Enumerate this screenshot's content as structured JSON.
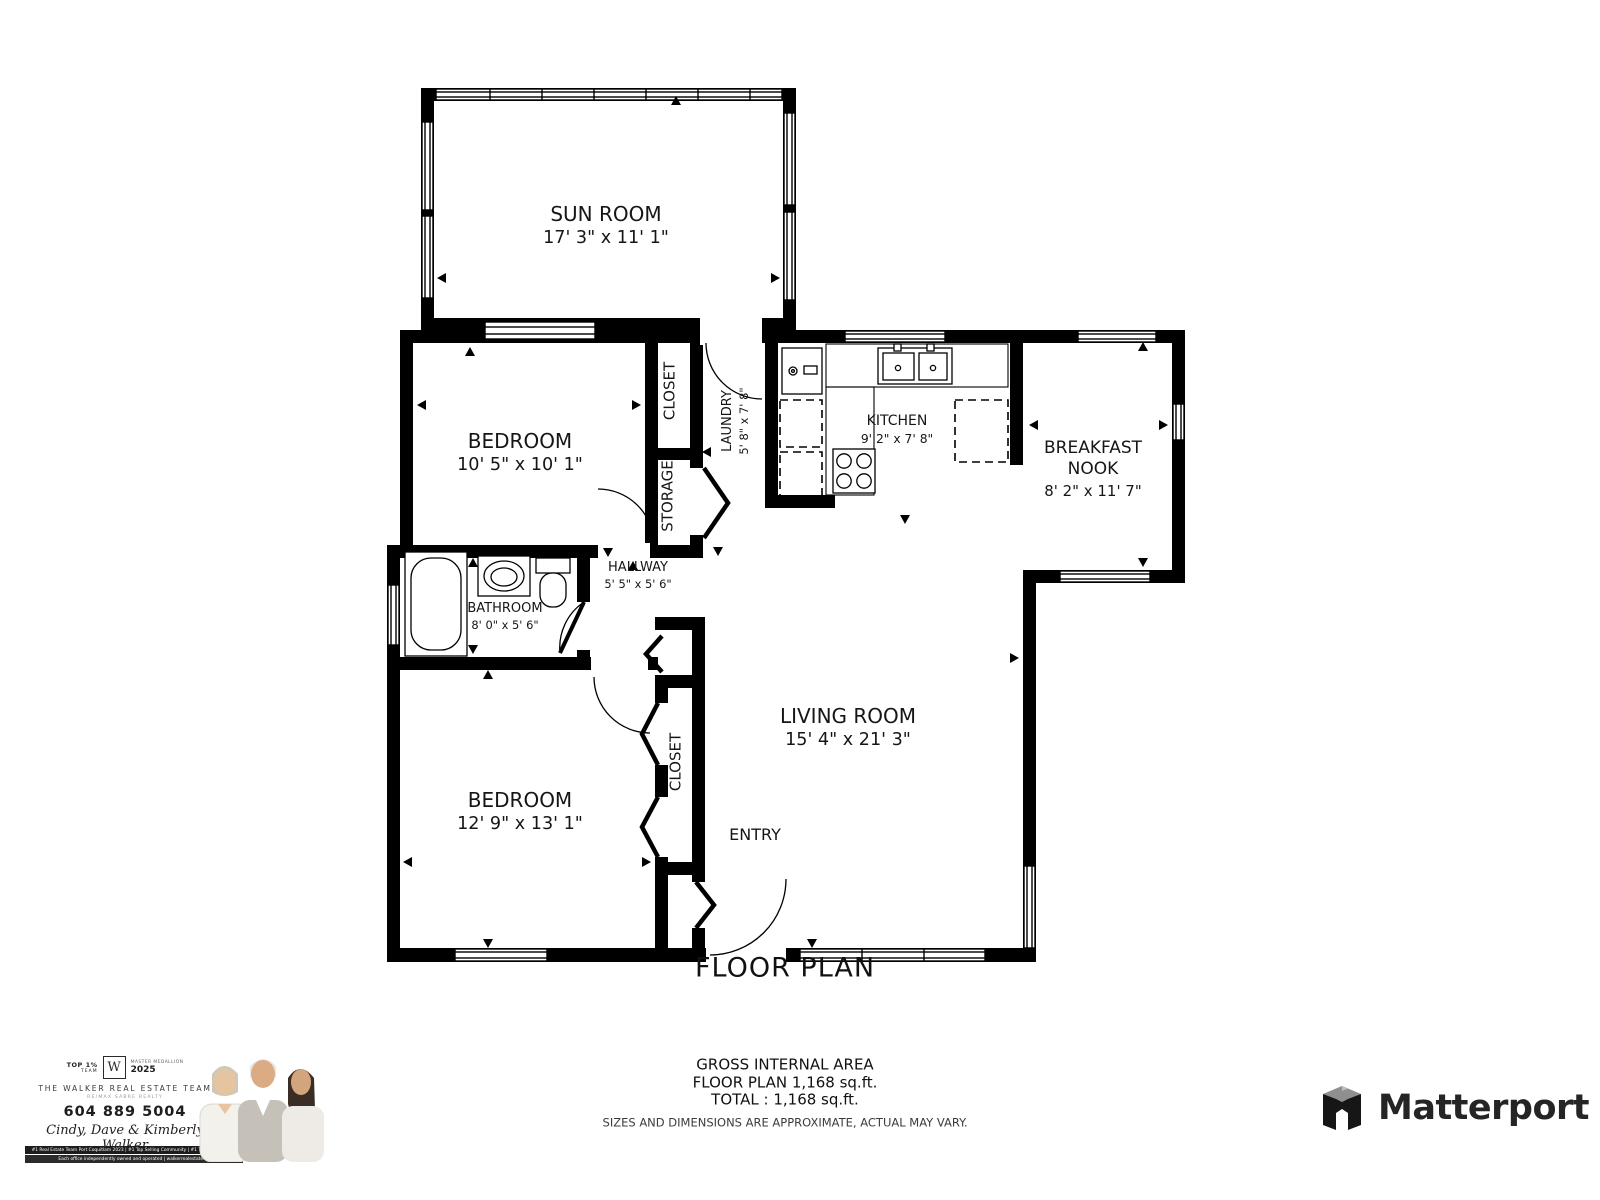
{
  "title": "FLOOR PLAN",
  "rooms": {
    "sun_room": {
      "name": "SUN ROOM",
      "dims": "17' 3\" x 11' 1\""
    },
    "bedroom_top": {
      "name": "BEDROOM",
      "dims": "10' 5\" x 10' 1\""
    },
    "closet_top": {
      "name": "CLOSET"
    },
    "storage": {
      "name": "STORAGE"
    },
    "laundry": {
      "name": "LAUNDRY",
      "dims": "5' 8\" x 7' 8\""
    },
    "kitchen": {
      "name": "KITCHEN",
      "dims": "9' 2\" x 7' 8\""
    },
    "breakfast_nook": {
      "line1": "BREAKFAST",
      "line2": "NOOK",
      "dims": "8' 2\" x 11' 7\""
    },
    "hallway": {
      "name": "HALLWAY",
      "dims": "5' 5\" x 5' 6\""
    },
    "bathroom": {
      "name": "BATHROOM",
      "dims": "8' 0\" x 5' 6\""
    },
    "bedroom_bottom": {
      "name": "BEDROOM",
      "dims": "12' 9\" x 13' 1\""
    },
    "closet_bottom": {
      "name": "CLOSET"
    },
    "living_room": {
      "name": "LIVING ROOM",
      "dims": "15' 4\" x 21' 3\""
    },
    "entry": {
      "name": "ENTRY"
    }
  },
  "footer": {
    "line1": "GROSS INTERNAL AREA",
    "line2": "FLOOR PLAN 1,168 sq.ft.",
    "line3": "TOTAL :  1,168 sq.ft.",
    "disclaimer": "SIZES AND DIMENSIONS ARE APPROXIMATE, ACTUAL MAY VARY."
  },
  "branding": {
    "top_badge_line1": "TOP 1%",
    "top_badge_line2": "TEAM",
    "logo_letter": "W",
    "award_line1": "MASTER MEDALLION",
    "award_year": "2025",
    "team_name": "THE WALKER REAL ESTATE TEAM",
    "team_sub": "RE/MAX SABRE REALTY",
    "phone": "604 889 5004",
    "agents": "Cindy, Dave & Kimberly Walker",
    "website": "WalkerRealEstate.ca",
    "email": "info@walkerrealestate.ca",
    "bar1": "#1 Real Estate Team Port Coquitlam 2023  |  #1 Top Selling Community  |  #1 Top Volume Team",
    "bar2": "Each office independently owned and operated  |  walkerrealestate.ca"
  },
  "matterport": {
    "wordmark": "Matterport"
  },
  "colors": {
    "wall": "#000000",
    "accent": "#1d1d1d",
    "disclaimer_gray": "#3c3c3c"
  }
}
